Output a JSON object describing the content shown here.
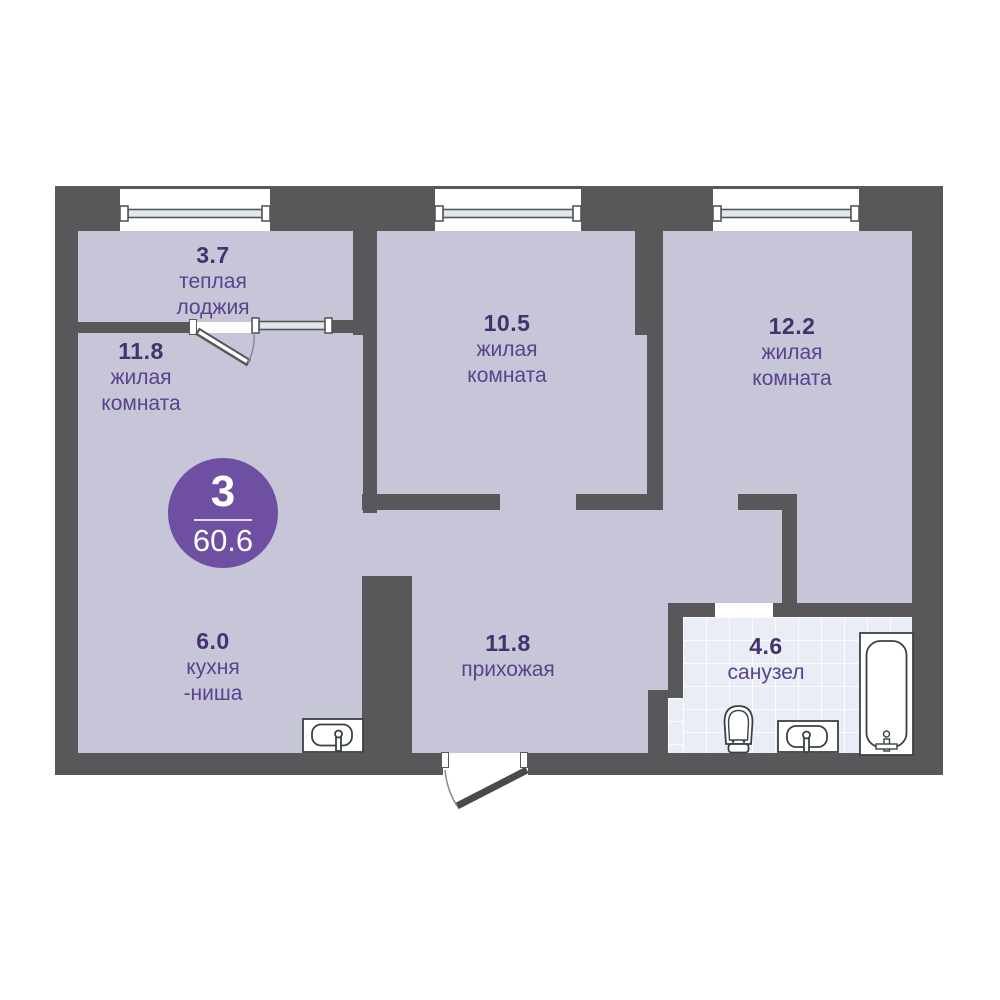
{
  "plan": {
    "type": "apartment-floor-plan",
    "badge": {
      "rooms_count": "3",
      "total_area": "60.6"
    },
    "rooms": {
      "loggia": {
        "area": "3.7",
        "name_line1": "теплая",
        "name_line2": "лоджия"
      },
      "living1": {
        "area": "11.8",
        "name_line1": "жилая",
        "name_line2": "комната"
      },
      "living2": {
        "area": "10.5",
        "name_line1": "жилая",
        "name_line2": "комната"
      },
      "living3": {
        "area": "12.2",
        "name_line1": "жилая",
        "name_line2": "комната"
      },
      "kitchen": {
        "area": "6.0",
        "name_line1": "кухня",
        "name_line2": "-ниша"
      },
      "hallway": {
        "area": "11.8",
        "name_line1": "прихожая",
        "name_line2": ""
      },
      "bathroom": {
        "area": "4.6",
        "name_line1": "санузел",
        "name_line2": ""
      }
    },
    "colors": {
      "wall": "#58585a",
      "floor": "#c7c5d8",
      "bathroom_tile": "#e9eef6",
      "badge": "#6e4fa1",
      "room_name_text": "#5a428c",
      "area_number_text": "#46316f",
      "fixture_stroke": "#3a4144",
      "window_glass": "#dfe9ed"
    },
    "icons": {
      "windows": "window-icon",
      "entrance_door": "door-swing-icon",
      "balcony_door": "door-swing-icon",
      "kitchen_sink": "sink-icon",
      "bathroom_sink": "sink-icon",
      "toilet": "toilet-icon",
      "bathtub": "bathtub-icon"
    }
  }
}
